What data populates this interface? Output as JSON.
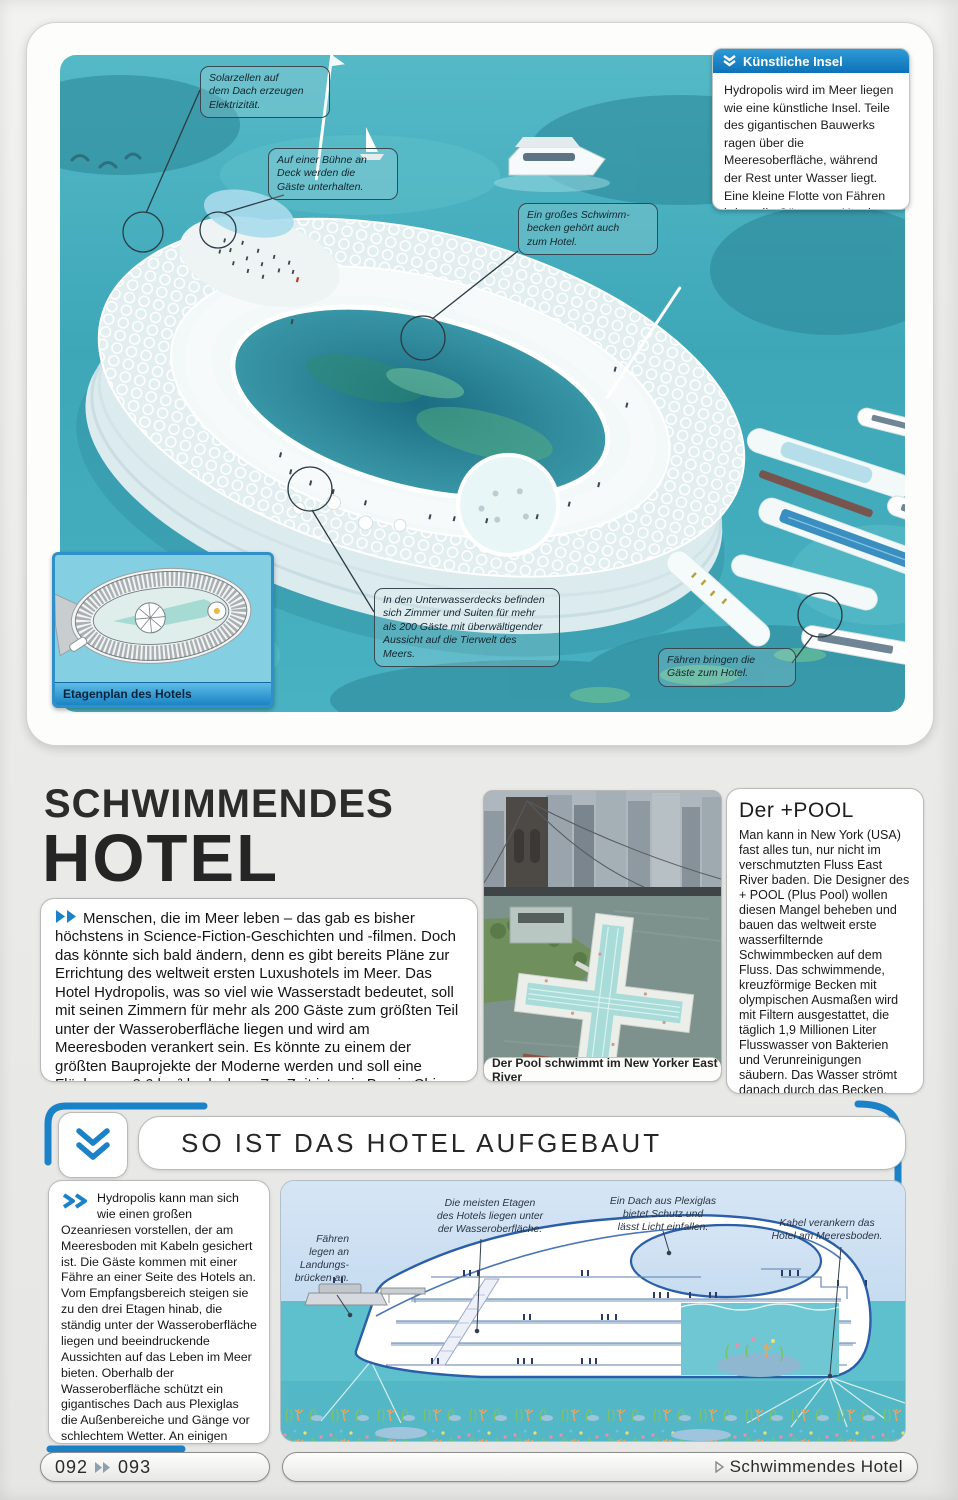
{
  "hero": {
    "info_box": {
      "title": "Künstliche Insel",
      "body": "Hydropolis wird im Meer liegen wie eine künstliche Insel. Teile des gigantischen Bauwerks ragen über die Meeresoberfläche, während der Rest unter Wasser liegt. Eine kleine Flotte von Fähren bringt die Gäste zum Hotel oder zum nahen Strand."
    },
    "callouts": [
      {
        "text": "Solarzellen auf\ndem Dach erzeugen\nElektrizität."
      },
      {
        "text": "Auf einer Bühne an\nDeck werden die\nGäste unterhalten."
      },
      {
        "text": "Ein großes Schwimm-\nbecken gehört auch\nzum Hotel."
      },
      {
        "text": "In den Unterwasserdecks befinden\nsich Zimmer und Suiten für mehr\nals 200 Gäste mit überwältigender\nAussicht auf die Tierwelt des Meers."
      },
      {
        "text": "Fähren bringen die\nGäste zum Hotel."
      }
    ],
    "inset_caption": "Etagenplan des Hotels"
  },
  "article": {
    "title_line1": "SCHWIMMENDES",
    "title_line2": "HOTEL",
    "intro": "Menschen, die im Meer leben – das gab es bisher höchstens in Science-Fiction-Geschichten und -filmen. Doch das könnte sich bald ändern, denn es gibt bereits Pläne zur Errichtung des weltweit ersten Luxushotels im Meer. Das Hotel Hydropolis, was so viel wie Wasserstadt bedeutet, soll mit seinen Zimmern für mehr als 200 Gäste zum größten Teil unter der Wasseroberfläche liegen und wird am Meeresboden verankert sein. Es könnte zu einem der größten Bauprojekte der Moderne werden und soll eine Fläche von 2,6 km² bedecken. Zur Zeit ist sein Bau in China geplant.",
    "photo_caption": "Der Pool schwimmt im New Yorker East River",
    "sidebar_title": "Der +POOL",
    "sidebar_body": "Man kann in New York (USA) fast alles tun, nur nicht im verschmutzten Fluss East River baden. Die Designer des + POOL (Plus Pool) wollen diesen Mangel beheben und bauen das weltweit erste wasserfilternde Schwimmbecken auf dem Fluss. Das schwimmende, kreuzförmige Becken mit olympischen Ausmaßen wird mit Filtern ausgestattet, die täglich 1,9 Millionen Liter Flusswasser von Bakterien und Verunreinigungen säubern. Das Wasser strömt danach durch das Becken, sodass die Besucher unbedenklich im gereinigten Flusswasser schwimmen können."
  },
  "how_section": {
    "title": "SO IST DAS HOTEL AUFGEBAUT",
    "body": "Hydropolis kann man sich wie einen großen Ozeanriesen vorstellen, der am Meeresboden mit Kabeln gesichert ist. Die Gäste kommen mit einer Fähre an einer Seite des Hotels an. Vom Empfangsbereich steigen sie zu den drei Etagen hinab, die ständig unter der Wasseroberfläche liegen und beeindruckende Aussichten auf das Leben im Meer bieten. Oberhalb der Wasseroberfläche schützt ein gigantisches Dach aus Plexiglas die Außenbereiche und Gänge vor schlechtem Wetter. An einigen Stellen des Dachs befinden sich Solarzellen, um die benötigte Elektrizität zu erzeugen.",
    "diagram_labels": [
      {
        "text": "Fähren\nlegen an\nLandungs-\nbrücken an."
      },
      {
        "text": "Die meisten Etagen\ndes Hotels liegen unter\nder Wasseroberfläche."
      },
      {
        "text": "Ein Dach aus Plexiglas\nbietet Schutz und\nlässt Licht einfallen."
      },
      {
        "text": "Kabel verankern das\nHotel am Meeresboden."
      }
    ]
  },
  "footer": {
    "page_left": "092",
    "page_right": "093",
    "section": "Schwimmendes Hotel"
  },
  "icons": {
    "info_header_icon": "chevron-double-down",
    "intro_marker_icon": "chevron-double-right",
    "how_section_icon": "chevron-double-down",
    "how_text_marker_icon": "chevron-double-right",
    "footer_pages_icon": "chevron-double-right",
    "footer_section_icon": "triangle-right"
  },
  "colors": {
    "accent_blue": "#1c82c8",
    "ocean_teal": "#45afc0",
    "diagram_sky": "#cfe1f3",
    "diagram_water": "#5ec0cd"
  }
}
